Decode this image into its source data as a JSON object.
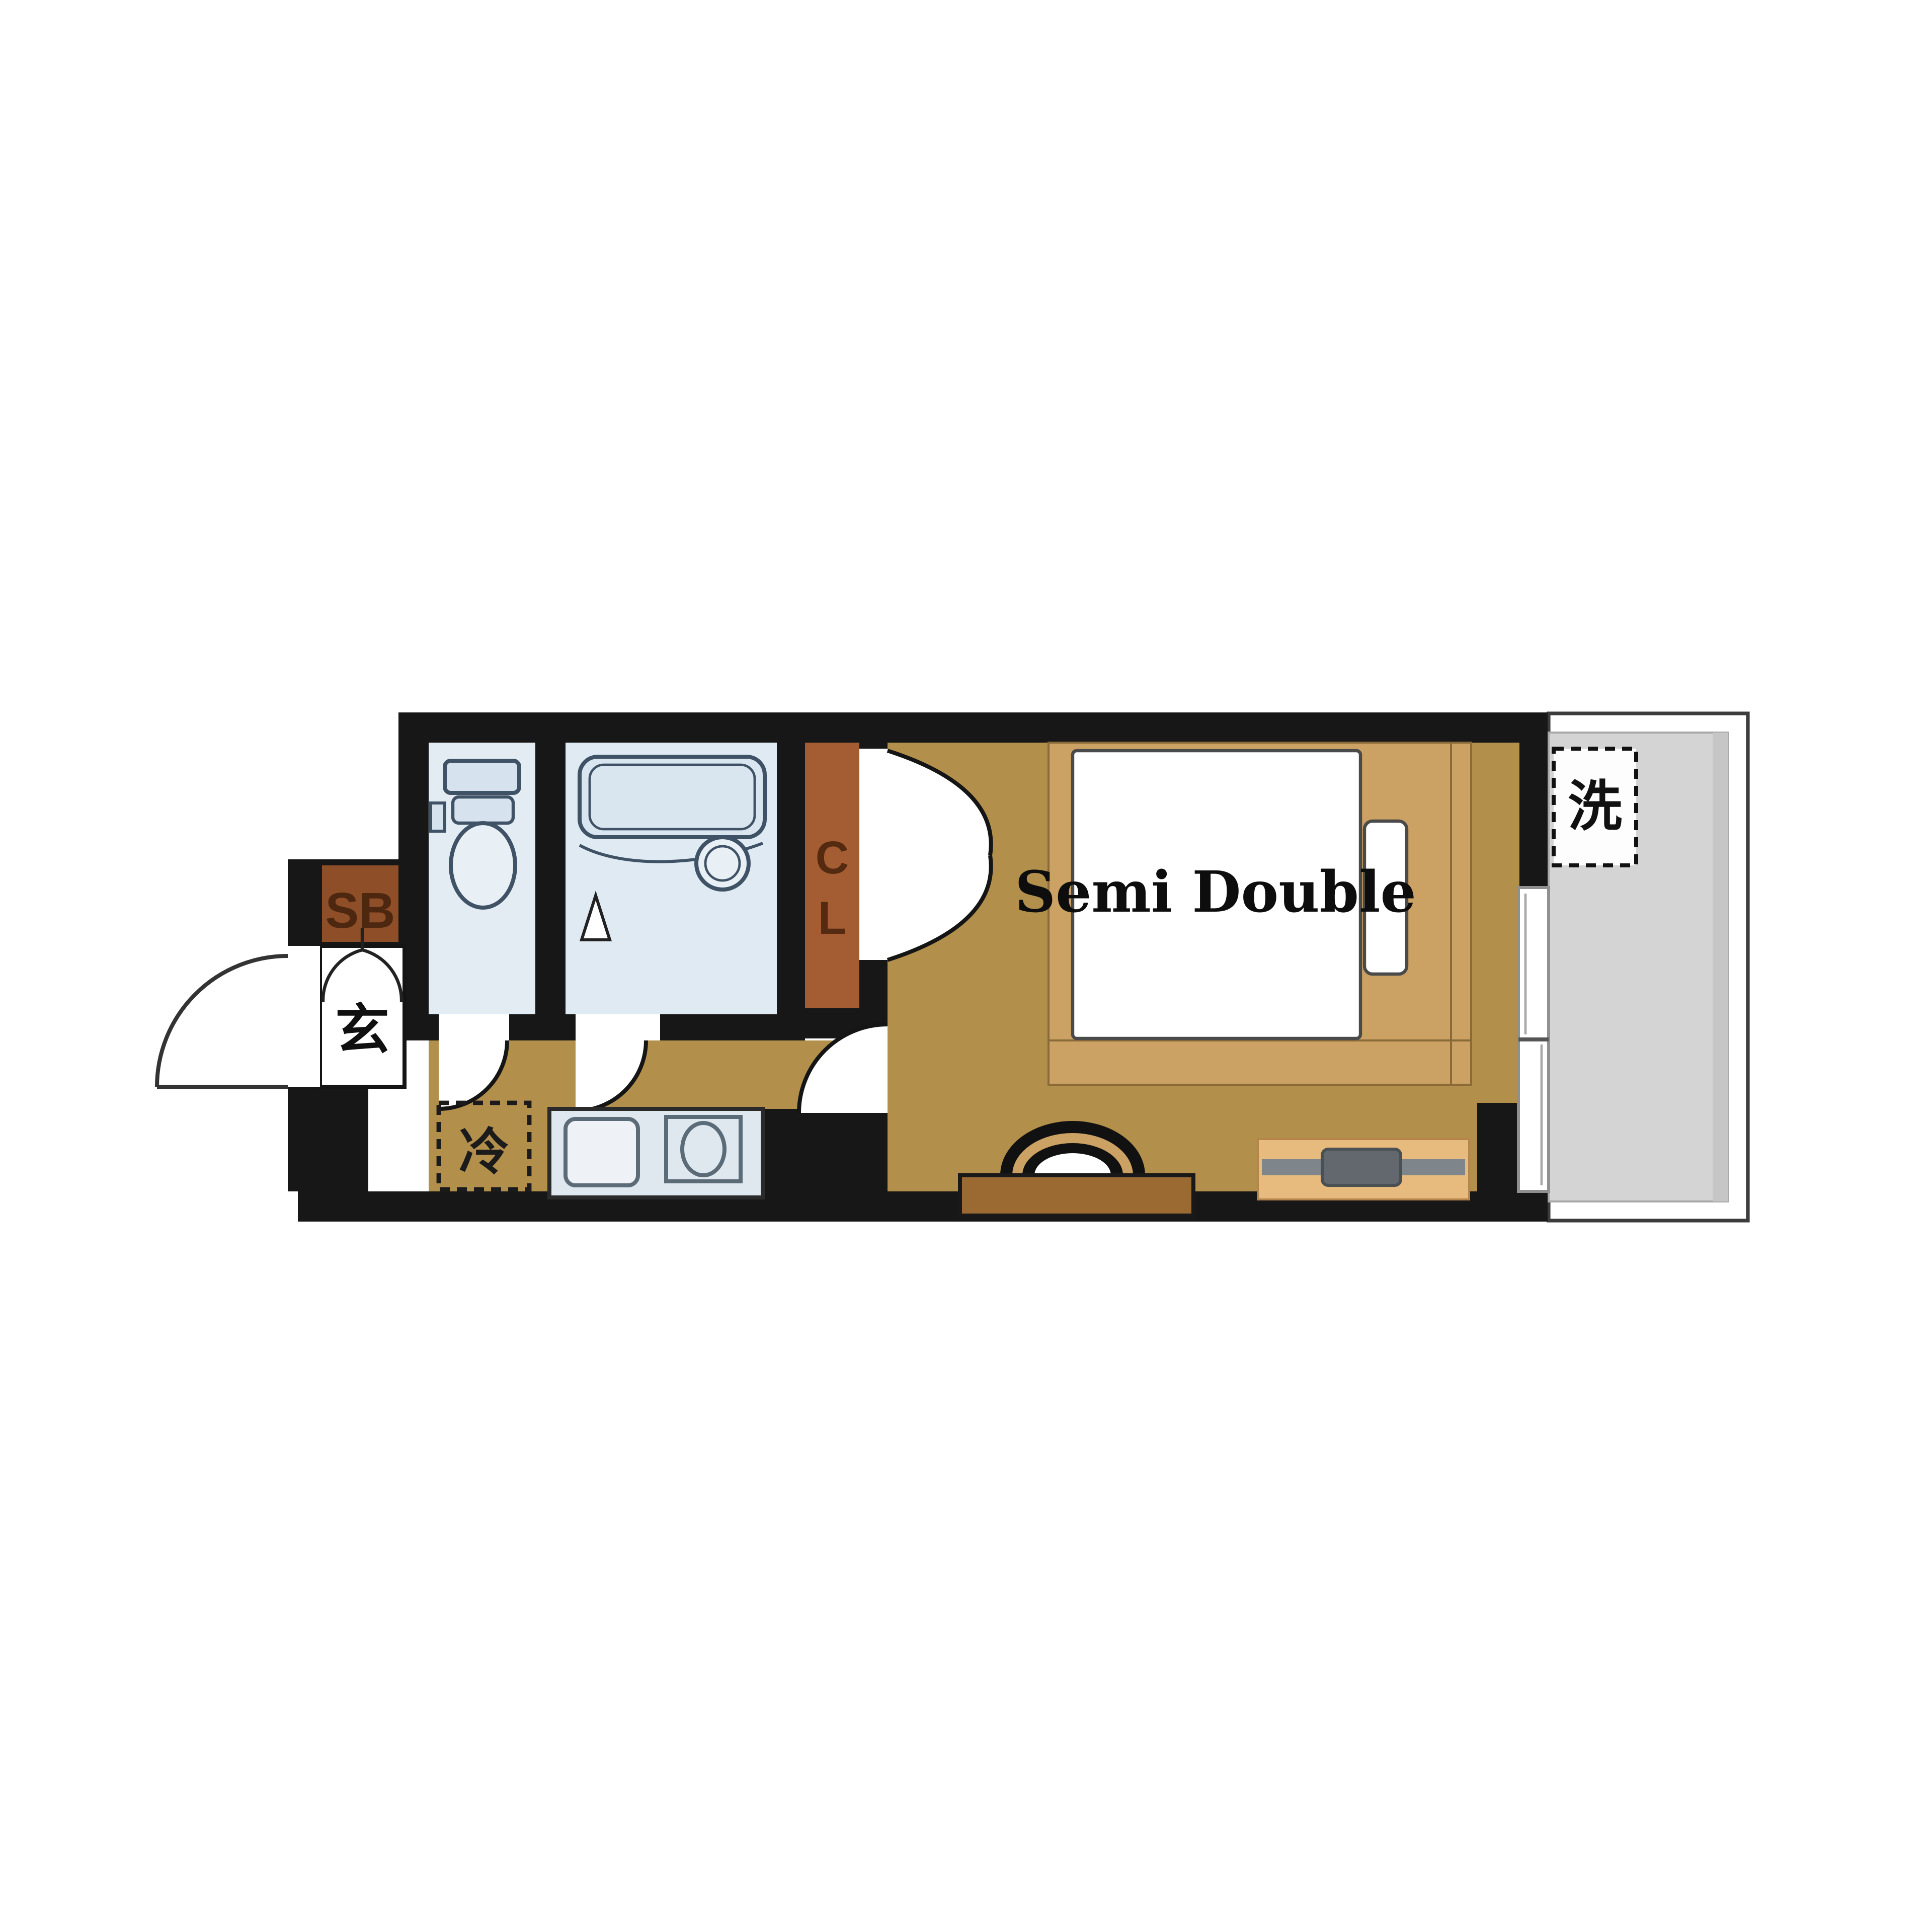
{
  "floor_plan": {
    "bed_label": "Semi Double",
    "closet_letters": [
      "C",
      "L"
    ],
    "entrance_label": "玄",
    "shoe_box_label": "SB",
    "refrigerator_label": "冷",
    "washing_machine_label": "洗",
    "colors": {
      "wall": "#171717",
      "flooring": "#b2904c",
      "wet_area_floor": "#e2eaf2",
      "closet_floor": "#a45c33",
      "shoe_box": "#8d4e28",
      "balcony_floor": "#d4d4d4",
      "bed_frame": "#cba164",
      "mattress": "#ffffff",
      "desk": "#9b6a33",
      "tv_board": "#e7ba7e",
      "tv": "#7e858b",
      "kitchen_counter": "#dfe8ef"
    }
  }
}
